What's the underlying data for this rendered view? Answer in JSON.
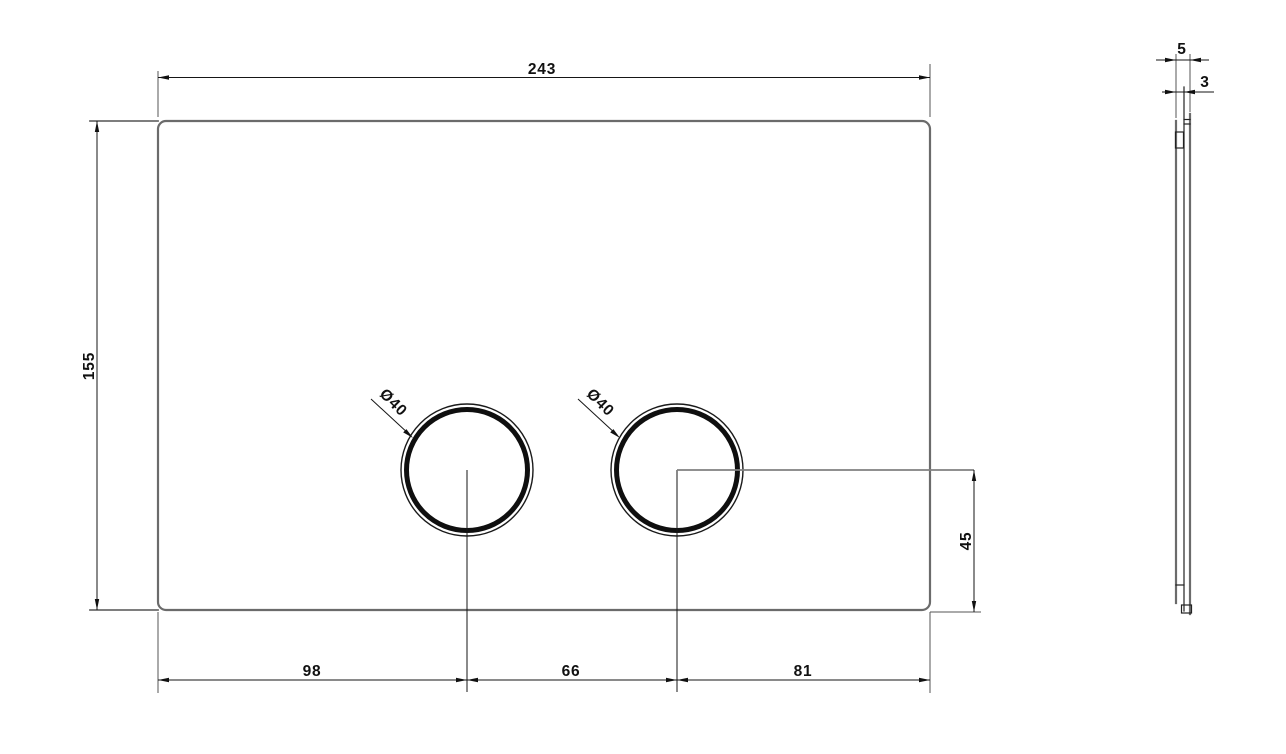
{
  "drawing": {
    "type": "technical-drawing",
    "subject": "dual-flush actuator plate, front and side views",
    "background": "#ffffff",
    "outline_color": "#6b6b6b",
    "dimension_color": "#161616"
  },
  "front_view": {
    "width": "243",
    "height": "155",
    "button_left_offset": "98",
    "button_spacing": "66",
    "button_right_offset": "81",
    "button_center_height": "45",
    "button_left_diameter": "Ø40",
    "button_right_diameter": "Ø40"
  },
  "side_view": {
    "total_depth": "5",
    "plate_thickness": "3"
  }
}
